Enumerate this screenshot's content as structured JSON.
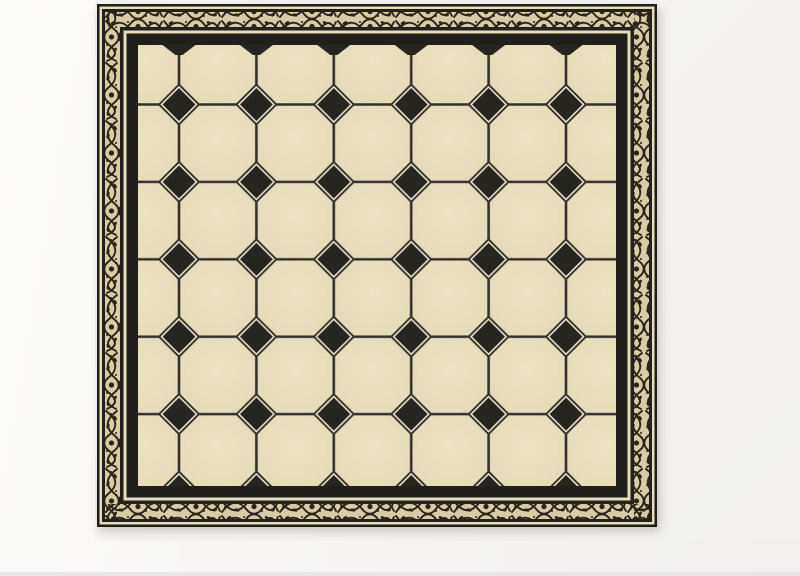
{
  "scene": {
    "description": "Rendered still-life of a square framed encaustic tile panel (octagon-and-dot floor pattern) standing on a plain light background. No text appears anywhere in the image.",
    "background_color": "#f7f6f4",
    "bottom_edge_color": "#e9e8e5",
    "panel": {
      "x": 97,
      "y": 4,
      "width": 560,
      "height": 523,
      "frame": {
        "outer_line_color": "#1e1d1a",
        "pinstripe_color": "#e7ddbb",
        "dark_line_color": "#23221e",
        "ornament_background": "#d8cca6",
        "ornament_ink": "#2b2418",
        "inner_band_color": "#201f1c",
        "ornament_band_thickness_px": 15,
        "bands_outside_in": [
          "dark edge",
          "cream pinstripe",
          "dark line",
          "black scrollwork band on cream",
          "dark line",
          "cream pinstripe",
          "black edging band"
        ]
      },
      "tile_pattern": {
        "type": "octagon-and-dot",
        "octagon_color": "#e4d9b5",
        "octagon_highlight": "#ece3c2",
        "dot_color": "#26251f",
        "dot_outline": "#f0e8cd",
        "grout_color": "#33312b",
        "cell_size_px": 77.4,
        "field_width_px": 478,
        "field_height_px": 441,
        "dot_grid_origin_x": 41,
        "dot_grid_origin_y": 59.5,
        "octagon_columns": 7,
        "octagon_rows": 6,
        "dot_columns": 6,
        "dot_rows": 5,
        "dot_diagonal_px": 38,
        "clipped_dot_row_bottom": true,
        "top_notch_count": 6,
        "top_notch_half_width": 16.5,
        "top_notch_depth": 10
      }
    }
  }
}
